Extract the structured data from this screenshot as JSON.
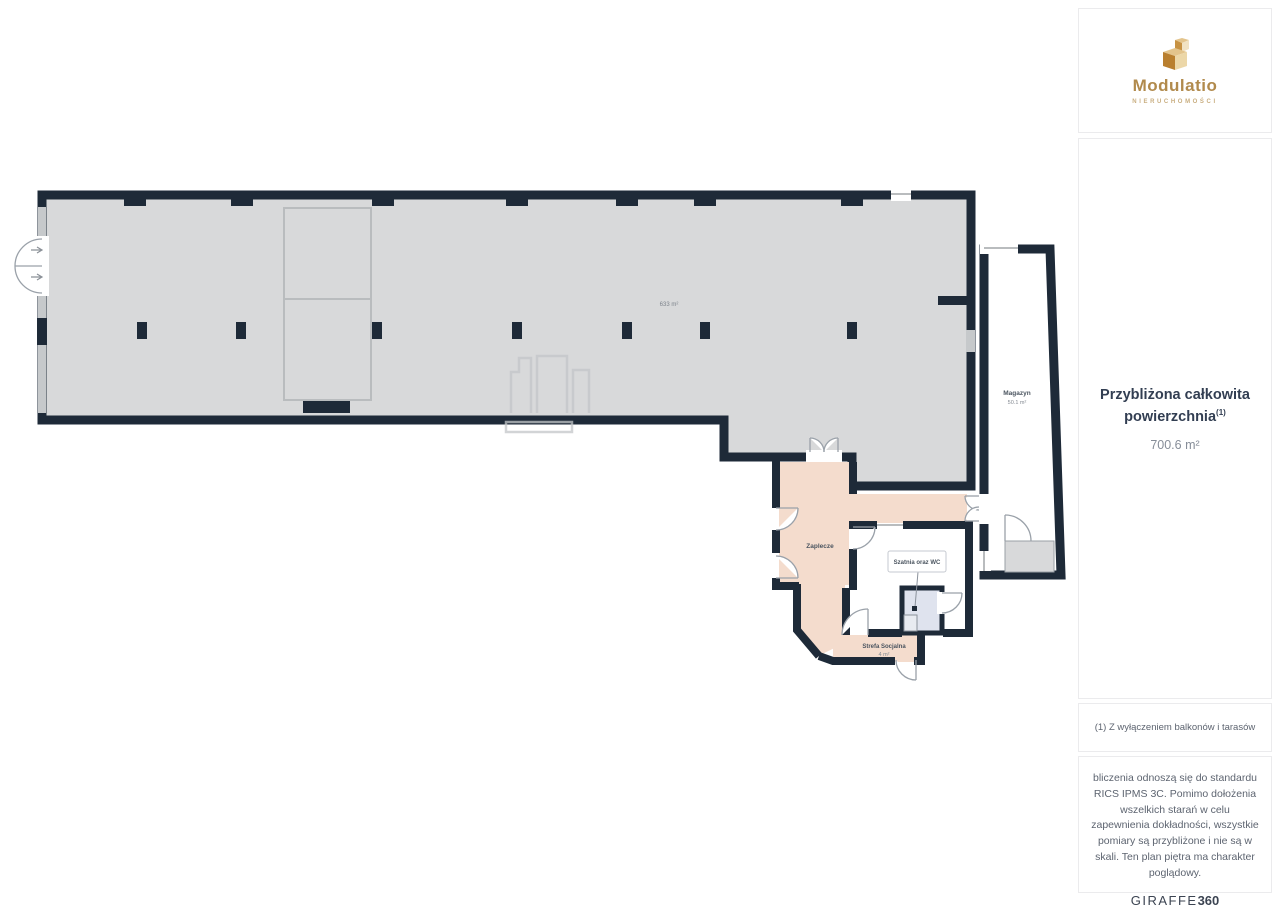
{
  "colors": {
    "wall": "#1e2a38",
    "floor_hall": "#d8d9da",
    "floor_zaplecze": "#f4dccd",
    "floor_wc": "#dfe3ee",
    "gold": "#b18a4c",
    "text_dark": "#323e52",
    "text_grey": "#868d98"
  },
  "sidebar": {
    "logo": {
      "name": "Modulatio",
      "subtitle": "NIERUCHOMOŚCI"
    },
    "summary": {
      "title": "Przybliżona całkowita powierzchnia",
      "superscript": "(1)",
      "value": "700.6 m²"
    },
    "footnote": "(1) Z wyłączeniem balkonów i tarasów",
    "disclaimer": "bliczenia odnoszą się do standardu RICS IPMS 3C. Pomimo dołożenia wszelkich starań w celu zapewnienia dokładności, wszystkie pomiary są przybliżone i nie są w skali. Ten plan piętra ma charakter poglądowy.",
    "giraffe": {
      "brand": "GIRAFFE",
      "suffix": "360"
    }
  },
  "floorplan": {
    "hall_area": "633 m²",
    "magazyn_name": "Magazyn",
    "magazyn_area": "50.1 m²",
    "zaplecze_name": "Zaplecze",
    "szatnia_name": "Szatnia oraz WC",
    "strefa_name": "Strefa Socjalna",
    "strefa_area": "4 m²"
  }
}
